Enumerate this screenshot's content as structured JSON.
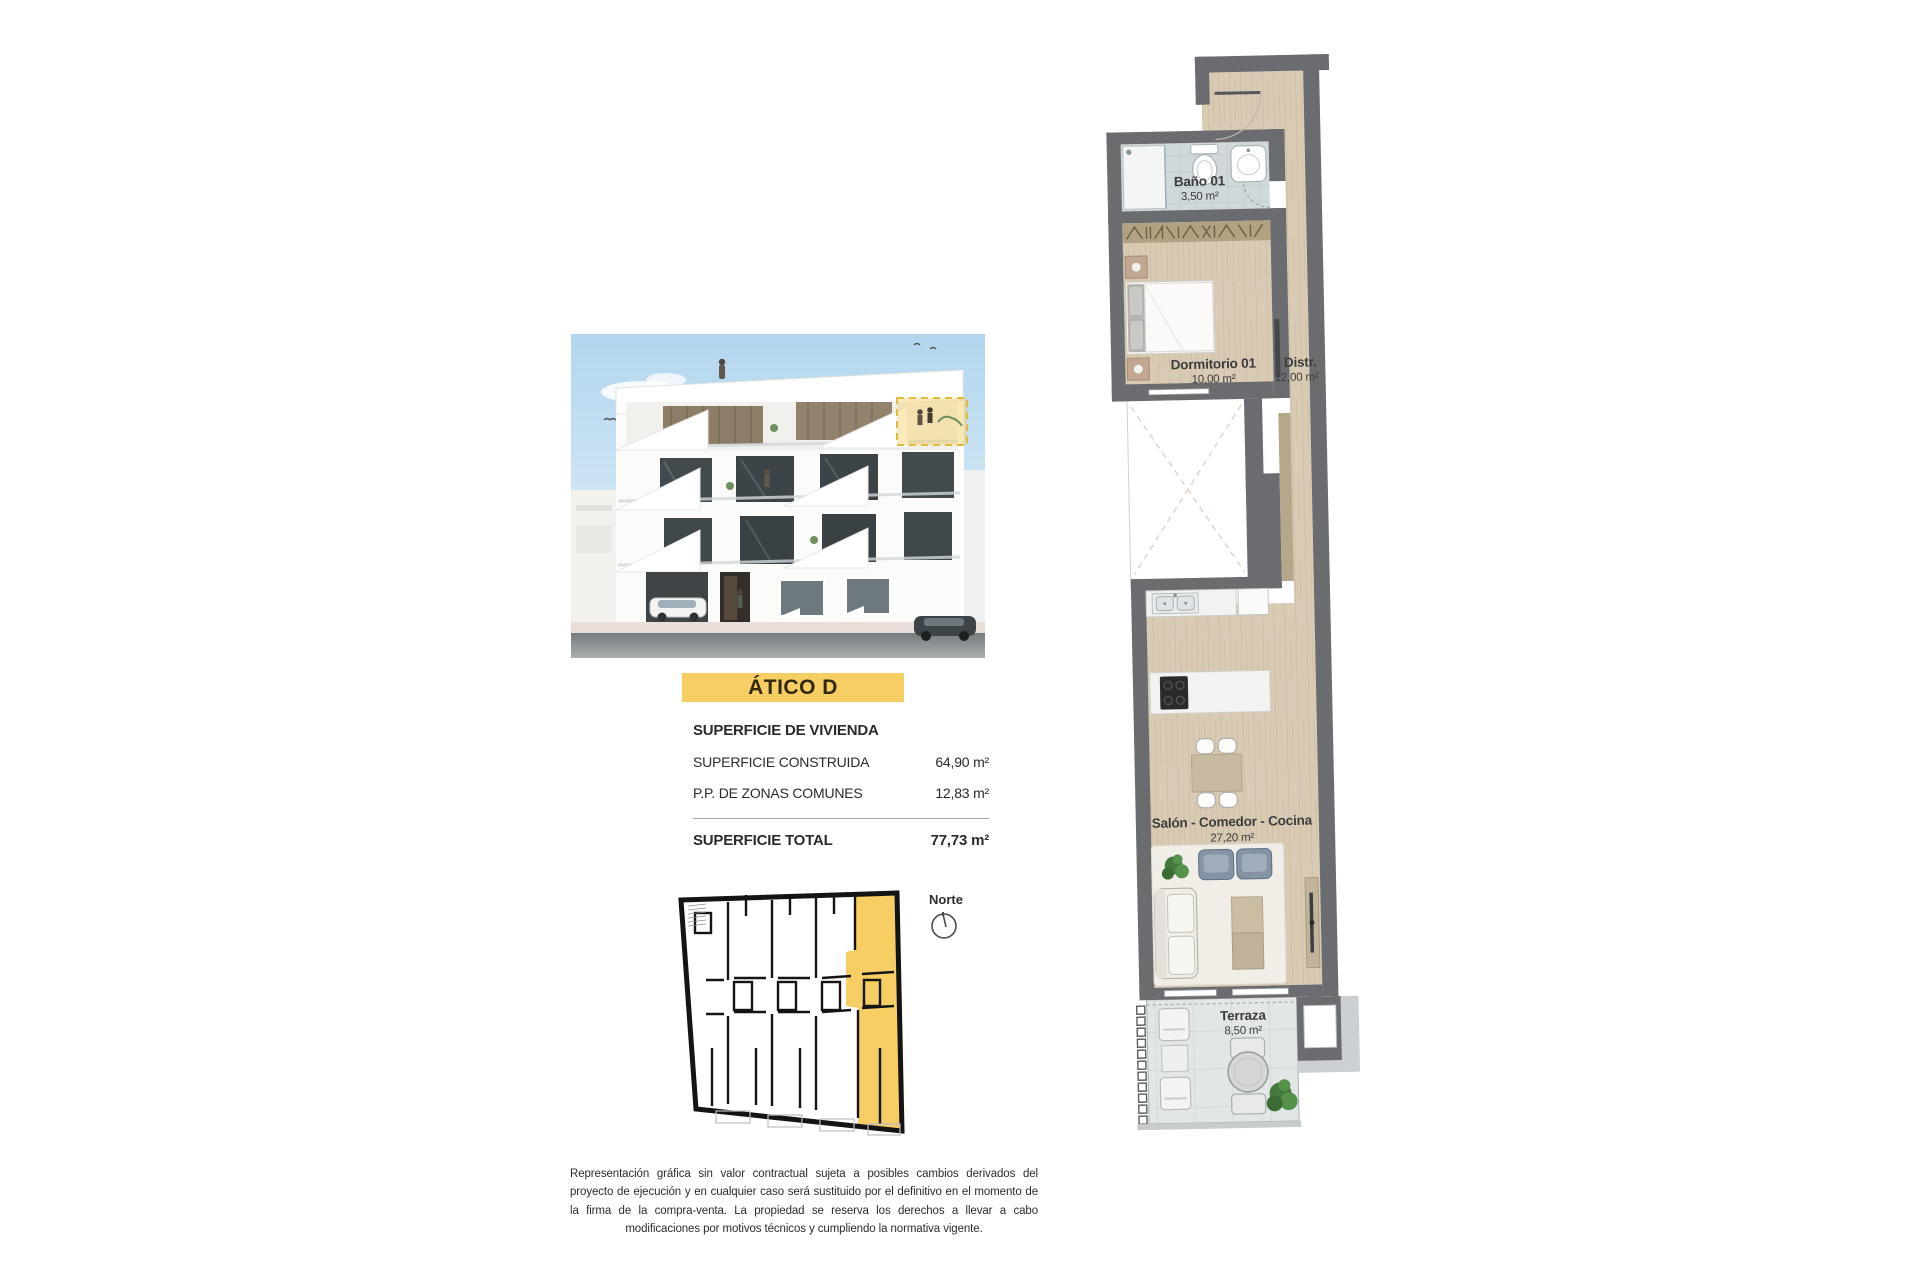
{
  "title_banner": {
    "label": "ÁTICO D",
    "bg": "#f6ce63"
  },
  "surface_info": {
    "header": "SUPERFICIE DE VIVIENDA",
    "rows": [
      {
        "label": "SUPERFICIE CONSTRUIDA",
        "value": "64,90 m²"
      },
      {
        "label": "P.P. DE ZONAS COMUNES",
        "value": "12,83 m²"
      }
    ],
    "total_label": "SUPERFICIE TOTAL",
    "total_value": "77,73 m²"
  },
  "key_plan": {
    "north_label": "Norte",
    "highlight_color": "#f6ce63"
  },
  "disclaimer": "Representación gráfica sin valor contractual sujeta a posibles cambios derivados del proyecto de ejecución y en cualquier caso será sustituido por el definitivo en el momento de la firma de la compra-venta. La propiedad se reserva los derechos a llevar a cabo modificaciones por motivos técnicos y cumpliendo la normativa vigente.",
  "floor_plan": {
    "rooms": [
      {
        "name": "Baño 01",
        "area": "3,50 m²"
      },
      {
        "name": "Dormitorio 01",
        "area": "10,00 m²"
      },
      {
        "name": "Distr.",
        "area": "12,00 m²"
      },
      {
        "name": "Salón - Comedor - Cocina",
        "area": "27,20 m²"
      },
      {
        "name": "Terraza",
        "area": "8,50 m²"
      }
    ],
    "colors": {
      "wall": "#6b6c6f",
      "wood": "#d9cab3",
      "bath": "#cfd8da",
      "terrace": "#e2e6e7",
      "highlight": "#f6ce63",
      "plant": "#4b7f41"
    }
  }
}
